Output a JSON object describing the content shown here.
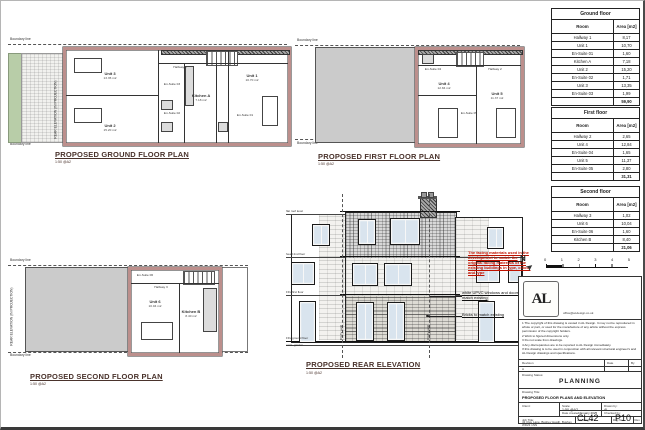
{
  "plans": {
    "ground": {
      "title": "PROPOSED GROUND FLOOR PLAN",
      "scale": "1:50 @A2",
      "boundary_top": "Boundary line",
      "boundary_bottom": "Boundary line",
      "side_label": "REAR ELEVATION (IN PROJECTION)",
      "rooms": {
        "unit3": {
          "name": "Unit 3",
          "area": "13.35 m2"
        },
        "unit2": {
          "name": "Unit 2",
          "area": "15.20 m2"
        },
        "kitchenA": {
          "name": "Kitchen A",
          "area": "7.18 m2"
        },
        "unit1": {
          "name": "Unit 1",
          "area": "10.70 m2"
        },
        "hallway1": {
          "name": "Hallway 1"
        },
        "ensuite1": {
          "name": "En-Suite 01"
        },
        "ensuite2": {
          "name": "En-Suite 02"
        },
        "ensuite3": {
          "name": "En-Suite 03"
        }
      }
    },
    "first": {
      "title": "PROPOSED FIRST FLOOR PLAN",
      "scale": "1:50 @A2",
      "boundary_top": "Boundary line",
      "boundary_bottom": "Boundary line",
      "rooms": {
        "unit4": {
          "name": "Unit 4",
          "area": "12.84 m2"
        },
        "unit5": {
          "name": "Unit 5",
          "area": "11.37 m2"
        },
        "hallway2": {
          "name": "Hallway 2"
        },
        "ensuite4": {
          "name": "En-Suite 04"
        },
        "ensuite5": {
          "name": "En-Suite 05"
        }
      }
    },
    "second": {
      "title": "PROPOSED SECOND FLOOR PLAN",
      "scale": "1:50 @A2",
      "boundary_top": "Boundary line",
      "boundary_bottom": "Boundary line",
      "side_label": "REAR ELEVATION (IN PROJECTION)",
      "rooms": {
        "unit6": {
          "name": "Unit 6",
          "area": "10.04 m2"
        },
        "kitchenB": {
          "name": "Kitchen B",
          "area": "8.40 m2"
        },
        "hallway3": {
          "name": "Hallway 3"
        },
        "ensuite6": {
          "name": "En-Suite 06"
        }
      }
    }
  },
  "elevation": {
    "title": "PROPOSED REAR ELEVATION",
    "scale": "1:50 @A2",
    "red_note": "The facing materials used in the development to match the original facing materials of the existing buildings in type, colour and type",
    "note_upvc": "white UPVC windows and doors to match existing",
    "note_bricks": "Bricks to match existing",
    "party_wall_left": "Party wall",
    "party_wall_right": "Party wall",
    "levels": [
      "flat roof level",
      "head 2nd floor",
      "FFL first floor",
      "FFL ground floor",
      "exist. garden"
    ]
  },
  "north": {
    "label": "N"
  },
  "scalebar": {
    "ticks": [
      "0",
      "1",
      "2",
      "3",
      "4",
      "5"
    ]
  },
  "tables": [
    {
      "title": "Ground floor",
      "col_room": "Room",
      "col_area": "Area [m2]",
      "rows": [
        [
          "Hallway 1",
          "8,17"
        ],
        [
          "Unit 1",
          "10,70"
        ],
        [
          "En-Suite 01",
          "1,60"
        ],
        [
          "Kitchen A",
          "7,18"
        ],
        [
          "Unit 2",
          "15,20"
        ],
        [
          "En-Suite 02",
          "1,71"
        ],
        [
          "Unit 3",
          "13,35"
        ],
        [
          "En-Suite 03",
          "1,99"
        ]
      ],
      "total": "59,90"
    },
    {
      "title": "First floor",
      "col_room": "Room",
      "col_area": "Area [m2]",
      "rows": [
        [
          "Hallway 2",
          "2,65"
        ],
        [
          "Unit 4",
          "12,84"
        ],
        [
          "En-Suite 04",
          "1,65"
        ],
        [
          "Unit 5",
          "11,37"
        ],
        [
          "En-Suite 05",
          "2,80"
        ]
      ],
      "total": "31,31"
    },
    {
      "title": "Second floor",
      "col_room": "Room",
      "col_area": "Area [m2]",
      "rows": [
        [
          "Hallway 3",
          "1,02"
        ],
        [
          "Unit 6",
          "10,04"
        ],
        [
          "En-Suite 06",
          "1,60"
        ],
        [
          "Kitchen B",
          "8,40"
        ]
      ],
      "total": "21,06"
    }
  ],
  "title_block": {
    "logo_text": "AL",
    "email": "office@al-design.co.uk",
    "notes": [
      "1   The copyright of this drawing is vested in AL Design. It may not be reproduced in whole or part, or used for the manufacture of any article without the express permission of the copyright holders.",
      "2   Work to figured dimensions only.",
      "3   Do not scale from drawings.",
      "4   Any discrepancies are to be reported to AL Design immediately.",
      "If this drawing is to be used in conjunction with all relevant structural engineer's and AL Design drawings and specifications."
    ],
    "rev_col_revision": "Revision",
    "rev_col_date": "Date",
    "rev_col_by": "By",
    "rev_row_revision": "A",
    "rev_row_date": "",
    "rev_row_by": "",
    "status_label": "Drawing Status:",
    "status": "PLANNING",
    "drawing_title_label": "Drawing Title:",
    "drawing_title": "PROPOSED FLOOR PLANS AND ELEVATION",
    "client_label": "Client:",
    "scale_label": "Scale:",
    "scale": "1:50 @A2",
    "drawn_label": "Drawn by:",
    "drawn": "AL",
    "date_label": "Date created:",
    "date": "January 2025",
    "checked_label": "Checked by:",
    "job_label": "Job Title:",
    "job": "43 Clay Lane, Bushey Heath, Bushey WD23 1NN",
    "dwg_label": "Job/Dwg No.:",
    "dwg_no": "CL42",
    "drg_label": "Drg No.:",
    "drg_no": "P10",
    "rev_label": "Rev"
  },
  "colors": {
    "wall_pink": "#bc8f8c",
    "roof_grey": "#cbcbcb",
    "garden_green": "#b8cda8",
    "window_glass": "#d9e4ee",
    "annotation_red": "#c11200",
    "title_maroon": "#4a332c"
  }
}
